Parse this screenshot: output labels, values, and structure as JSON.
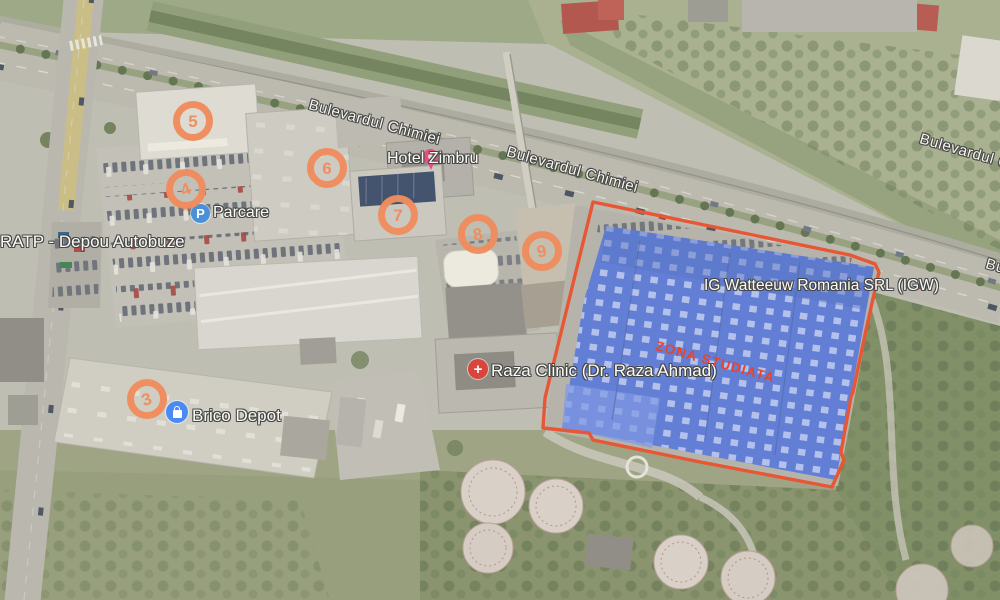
{
  "map": {
    "road_labels": [
      {
        "text": "Bulevardul Chimiei"
      },
      {
        "text": "Bulevardul Chimiei"
      },
      {
        "text": "Bulevardul Chimiei"
      },
      {
        "text": "Bulevardul Chimiei"
      }
    ],
    "pois": [
      {
        "name": "RATP - Depou Autobuze"
      },
      {
        "name": "Parcare",
        "icon": "parking",
        "glyph": "P"
      },
      {
        "name": "Hotel Zimbru",
        "icon": "lodging"
      },
      {
        "name": "Brico Depot",
        "icon": "store"
      },
      {
        "name": "Raza Clinic (Dr. Raza Ahmad)",
        "icon": "medical",
        "glyph": "+"
      },
      {
        "name": "IG Watteeuw Romania SRL (IGW)"
      }
    ],
    "study_zone": {
      "label": "ZONA STUDIATA",
      "outline_color": "#e84e2a",
      "label_color": "#e8432b",
      "highlight_color": "#5b79d4"
    },
    "markers": {
      "color": "#f08d5e",
      "items": [
        {
          "number": "3"
        },
        {
          "number": "4"
        },
        {
          "number": "5"
        },
        {
          "number": "6"
        },
        {
          "number": "7"
        },
        {
          "number": "8"
        },
        {
          "number": "9"
        }
      ]
    }
  }
}
